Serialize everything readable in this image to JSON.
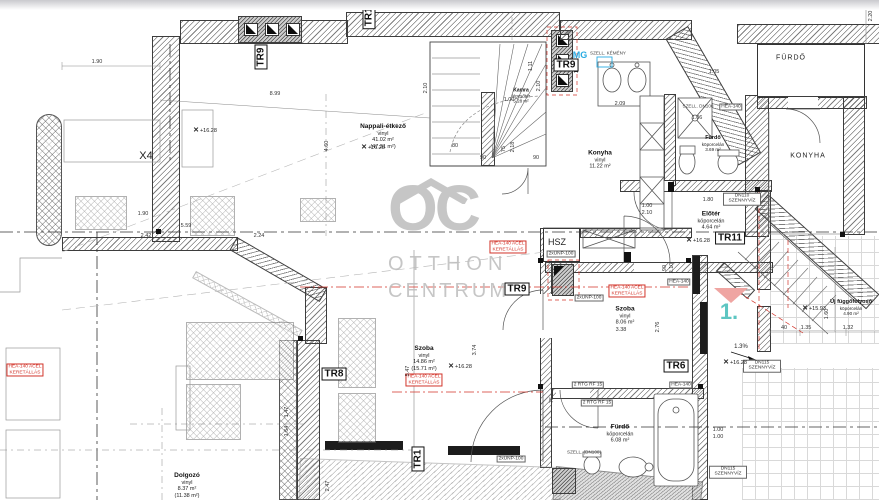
{
  "watermark": {
    "symbol": "OC",
    "line1": "OTTHON",
    "line2": "CENTRUM"
  },
  "rooms": [
    {
      "name": "Nappali-étkező",
      "l2": "vinyl",
      "l3": "41.02 m²",
      "l4": "(47.31 m²)"
    },
    {
      "name": "Kamra",
      "l2": "lépcsőtér",
      "l3": "5.28 m²",
      "l4": ""
    },
    {
      "name": "Konyha",
      "l2": "vinyl",
      "l3": "11.22 m²",
      "l4": ""
    },
    {
      "name": "Fürdő",
      "l2": "köporcelán",
      "l3": "3.69 m²",
      "l4": ""
    },
    {
      "name": "Előtér",
      "l2": "köporcelán",
      "l3": "4.64 m²",
      "l4": ""
    },
    {
      "name": "Szoba",
      "l2": "vinyl",
      "l3": "8.06 m²",
      "l4": ""
    },
    {
      "name": "Szoba",
      "l2": "vinyl",
      "l3": "14.86 m²",
      "l4": "(15.71 m²)"
    },
    {
      "name": "Fürdő",
      "l2": "köporcelán",
      "l3": "6.08 m²",
      "l4": ""
    },
    {
      "name": "Új függőfolyosó",
      "l2": "köporcelán",
      "l3": "4.90 m²",
      "l4": ""
    },
    {
      "name": "Dolgozó",
      "l2": "vinyl",
      "l3": "8.37 m²",
      "l4": "(11.38 m²)"
    },
    {
      "name": "FÜRDŐ"
    },
    {
      "name": "KONYHA"
    },
    {
      "name": "HSZ"
    }
  ],
  "tr_tags": [
    {
      "label": "TR10"
    },
    {
      "label": "TR9"
    },
    {
      "label": "TR9"
    },
    {
      "label": "TR9"
    },
    {
      "label": "TR8"
    },
    {
      "label": "TR6"
    },
    {
      "label": "TR11"
    },
    {
      "label": "TR1"
    }
  ],
  "notes": [
    {
      "t": "2xUNP-100"
    },
    {
      "t": "2xUNP-100"
    },
    {
      "t": "2xUNP-100"
    },
    {
      "t": "2 RTG RF 15"
    },
    {
      "t": "2 RTG RF 15"
    },
    {
      "t": "HEA-140"
    },
    {
      "t": "HEA-140"
    },
    {
      "t": "HEA-140"
    },
    {
      "t": "DN110 SZENNYVÍZ"
    },
    {
      "t": "DN115 SZENNYVÍZ"
    },
    {
      "t": "DN115 SZENNYVÍZ"
    },
    {
      "t": "SZELL. KÉMÉNY"
    },
    {
      "t": "SZELL. DN100"
    },
    {
      "t": "SZELL. (DN100)"
    }
  ],
  "red_notes": [
    {
      "l1": "HEA-140 ACÉL",
      "l2": "KERETÁLLÁS"
    },
    {
      "l1": "HEA-140 ACÉL",
      "l2": "KERETÁLLÁS"
    },
    {
      "l1": "HEA-140 ACÉL",
      "l2": "KERETÁLLÁS"
    },
    {
      "l1": "HEA-140 ACÉL",
      "l2": "KERETÁLLÁS"
    }
  ],
  "levels": [
    {
      "t": "+16.28"
    },
    {
      "t": "+16.28"
    },
    {
      "t": "+16.28"
    },
    {
      "t": "+16.28"
    },
    {
      "t": "+16.28"
    },
    {
      "t": "+15.93"
    }
  ],
  "misc": {
    "mg": "MG",
    "one": "1.",
    "x4": "X4",
    "slope": "1.3%"
  },
  "dims": [
    {
      "t": "1.90"
    },
    {
      "t": "8.99"
    },
    {
      "t": "1.90"
    },
    {
      "t": "5.59"
    },
    {
      "t": "2.42"
    },
    {
      "t": "2.24"
    },
    {
      "t": "4.60"
    },
    {
      "t": "2.10"
    },
    {
      "t": "2.20"
    },
    {
      "t": "1.11"
    },
    {
      "t": "1.00"
    },
    {
      "t": "2.10"
    },
    {
      "t": "80"
    },
    {
      "t": "75"
    },
    {
      "t": "2.18"
    },
    {
      "t": "90"
    },
    {
      "t": "90"
    },
    {
      "t": "1.52"
    },
    {
      "t": "2.09"
    },
    {
      "t": "1.05"
    },
    {
      "t": "1.06"
    },
    {
      "t": "1.80"
    },
    {
      "t": "1.00"
    },
    {
      "t": "2.10"
    },
    {
      "t": "90"
    },
    {
      "t": "2.10"
    },
    {
      "t": "3.38"
    },
    {
      "t": "2.76"
    },
    {
      "t": "3.74"
    },
    {
      "t": "5.47"
    },
    {
      "t": "2.47"
    },
    {
      "t": "1.47"
    },
    {
      "t": "1.64"
    },
    {
      "t": "75"
    },
    {
      "t": "1.00"
    },
    {
      "t": "1.00"
    },
    {
      "t": "1.60"
    },
    {
      "t": "1.35"
    },
    {
      "t": "40"
    },
    {
      "t": "1.32"
    }
  ],
  "colors": {
    "red": "#d2342a",
    "blue": "#29abe2",
    "teal": "#35b8b4",
    "pink": "#efa5a2",
    "watermark": "#bdbdbd"
  }
}
